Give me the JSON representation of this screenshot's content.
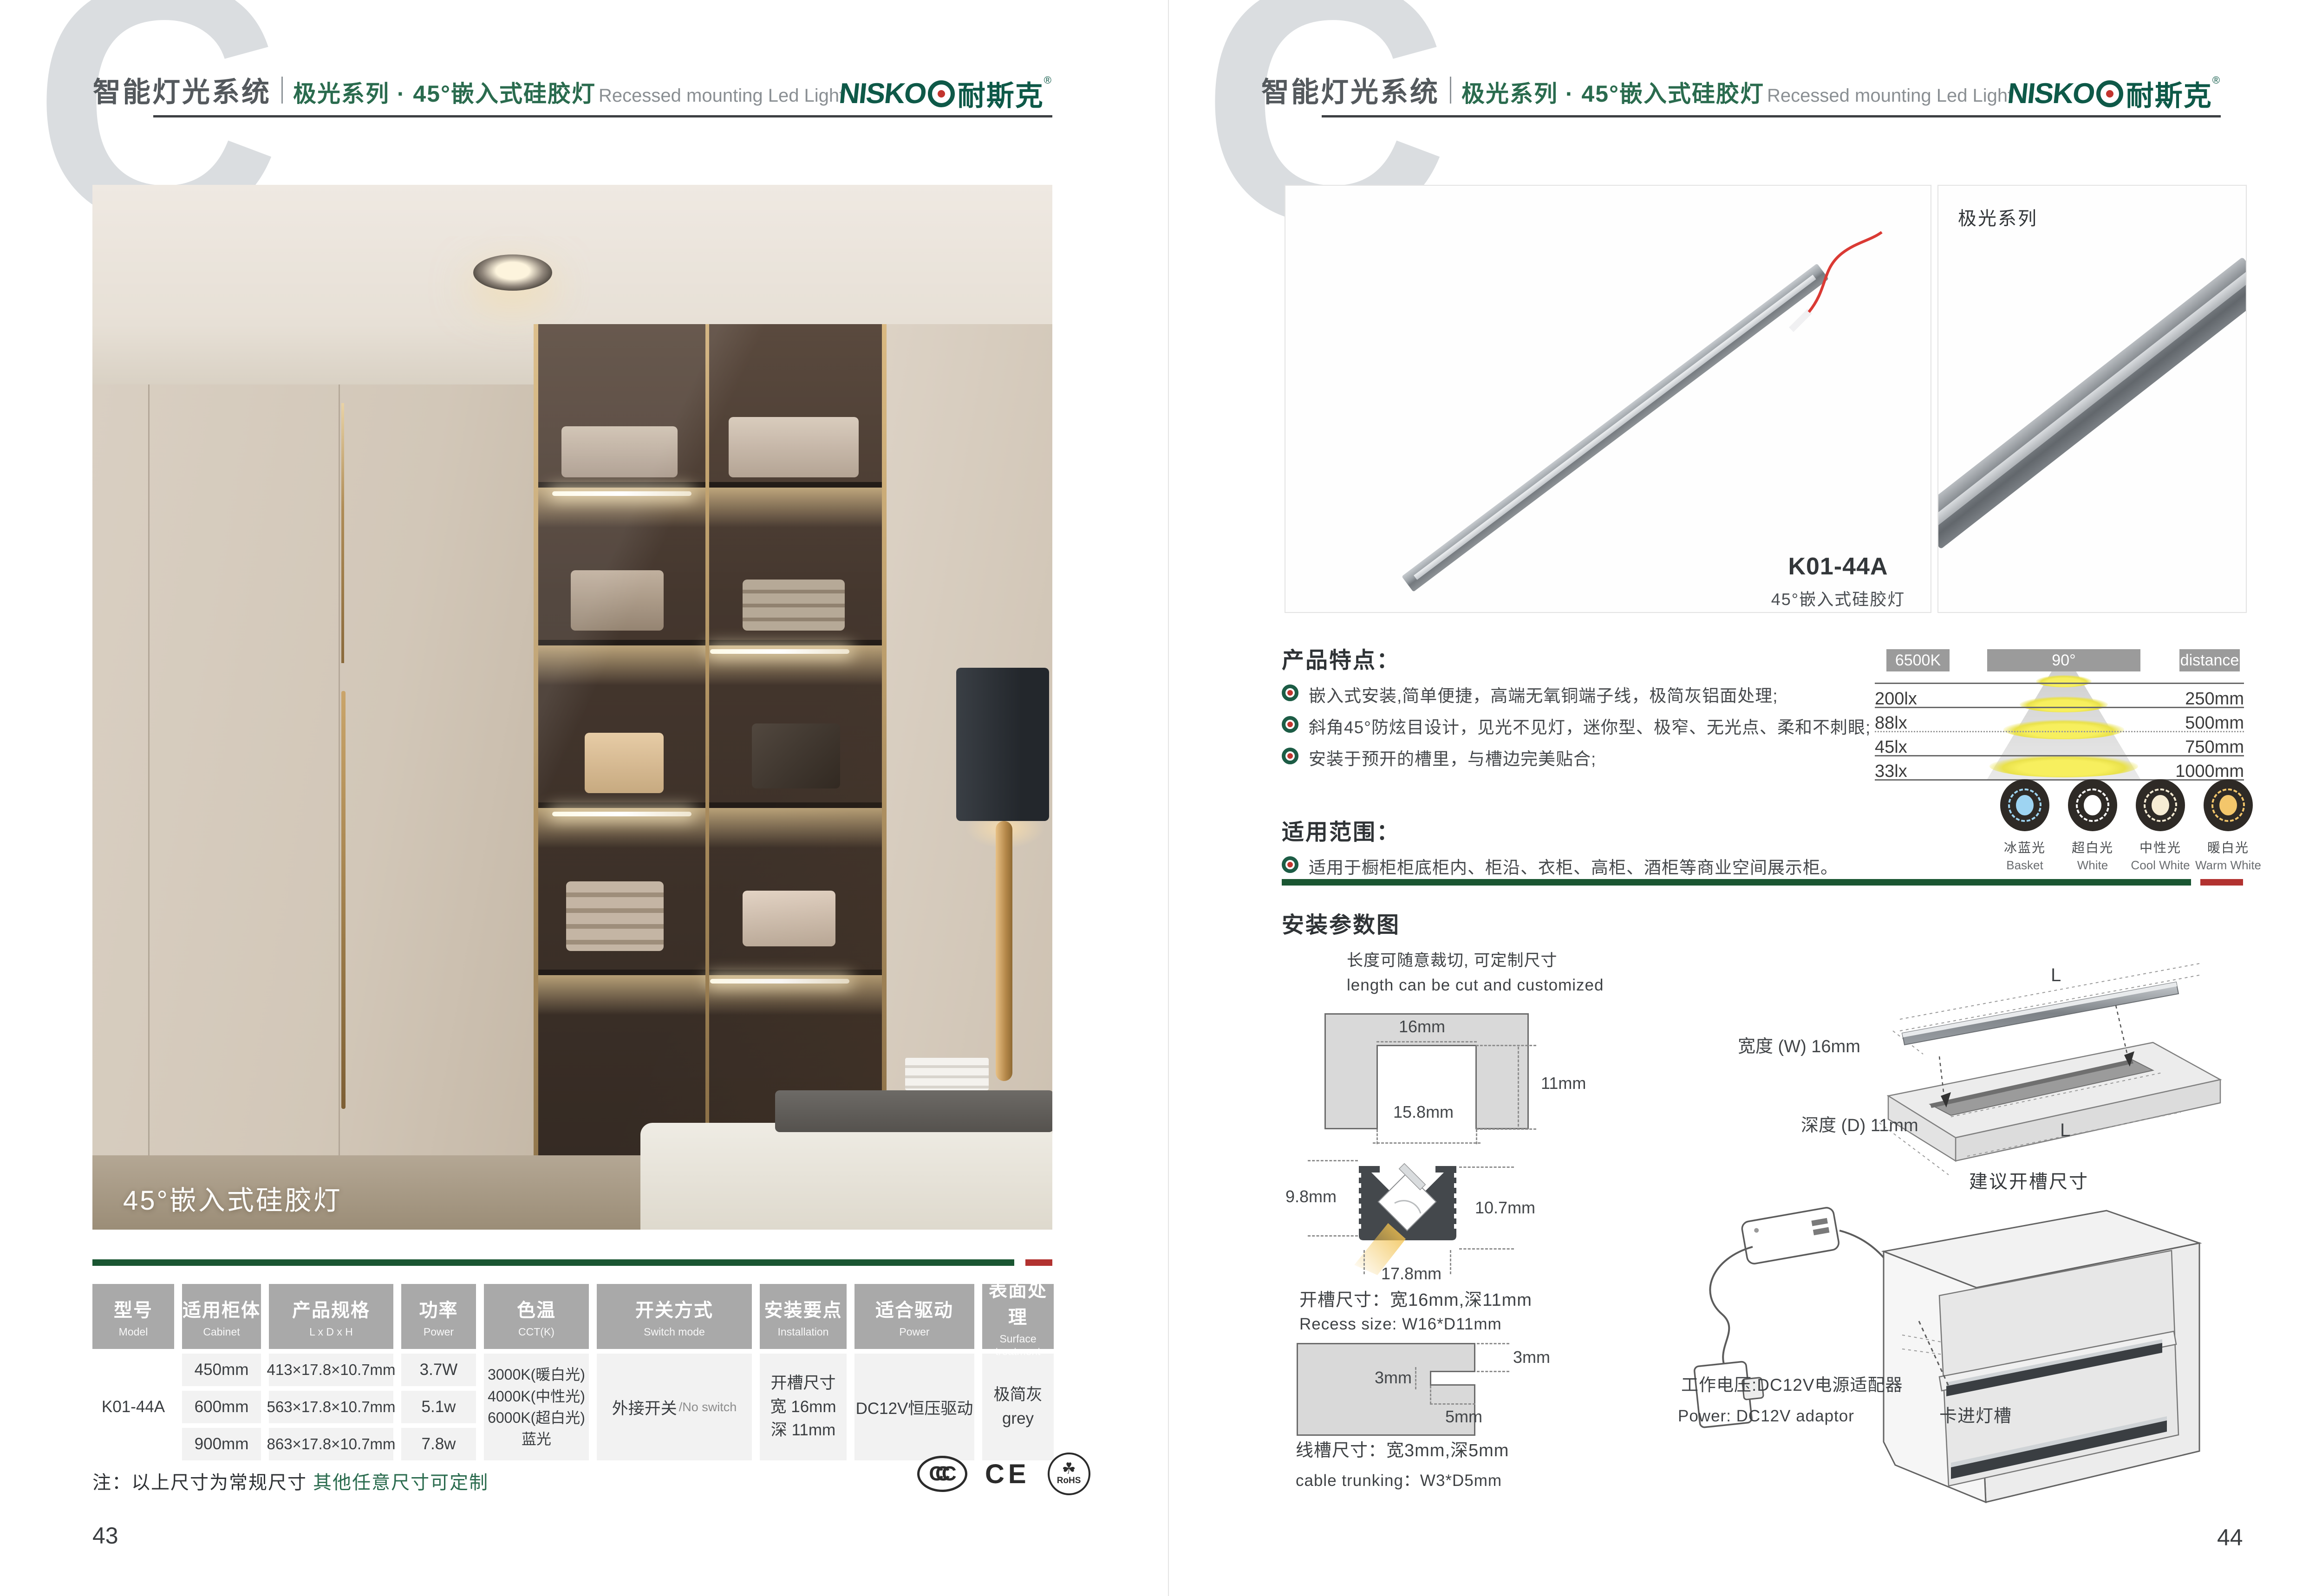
{
  "colors": {
    "brand_green": "#2a6b4e",
    "logo_green": "#0e5948",
    "divider_green": "#1a5632",
    "accent_red": "#b23230",
    "table_header_gray": "#a9a9a9"
  },
  "header": {
    "watermark": "C",
    "brand_title": "智能灯光系统",
    "series_title": "极光系列 · 45°嵌入式硅胶灯",
    "subtitle_en": "Recessed mounting Led Light",
    "logo": {
      "latin": "NISKO",
      "cn": "耐斯克",
      "reg": "®"
    }
  },
  "left_page": {
    "photo_caption": "45°嵌入式硅胶灯",
    "table": {
      "headers": [
        {
          "zh": "型号",
          "en": "Model"
        },
        {
          "zh": "适用柜体",
          "en": "Cabinet"
        },
        {
          "zh": "产品规格",
          "en": "L x D x H"
        },
        {
          "zh": "功率",
          "en": "Power"
        },
        {
          "zh": "色温",
          "en": "CCT(K)"
        },
        {
          "zh": "开关方式",
          "en": "Switch mode"
        },
        {
          "zh": "安装要点",
          "en": "Installation"
        },
        {
          "zh": "适合驱动",
          "en": "Power"
        },
        {
          "zh": "表面处理",
          "en": "Surface treatment"
        }
      ],
      "model": "K01-44A",
      "rows": [
        {
          "cabinet": "450mm",
          "spec": "413×17.8×10.7mm",
          "power": "3.7W"
        },
        {
          "cabinet": "600mm",
          "spec": "563×17.8×10.7mm",
          "power": "5.1w"
        },
        {
          "cabinet": "900mm",
          "spec": "863×17.8×10.7mm",
          "power": "7.8w"
        }
      ],
      "cct": [
        "3000K(暖白光)",
        "4000K(中性光)",
        "6000K(超白光)",
        "蓝光"
      ],
      "switch_zh": "外接开关",
      "switch_en": "/No switch",
      "install": [
        "开槽尺寸",
        "宽 16mm",
        "深 11mm"
      ],
      "driver": "DC12V恒压驱动",
      "surface": [
        "极简灰",
        "grey"
      ]
    },
    "note": {
      "prefix": "注：以上尺寸为常规尺寸 ",
      "highlight": "其他任意尺寸可定制"
    },
    "certs": [
      "CCC",
      "CE",
      "RoHS"
    ],
    "page_number": "43"
  },
  "right_page": {
    "panel1": {
      "model": "K01-44A",
      "name": "45°嵌入式硅胶灯"
    },
    "panel2": {
      "label": "极光系列"
    },
    "features": {
      "title": "产品特点：",
      "items": [
        "嵌入式安装,简单便捷，高端无氧铜端子线，极简灰铝面处理;",
        "斜角45°防炫目设计，见光不见灯，迷你型、极窄、无光点、柔和不刺眼;",
        "安装于预开的槽里，与槽边完美贴合;"
      ]
    },
    "scope": {
      "title": "适用范围：",
      "items": [
        "适用于橱柜柜底柜内、柜沿、衣柜、高柜、酒柜等商业空间展示柜。"
      ]
    },
    "chart": {
      "kelvin": "6500K",
      "angle": "90°",
      "distance_label": "distance",
      "rows": [
        {
          "lux": "200lx",
          "mm": "250mm"
        },
        {
          "lux": "88lx",
          "mm": "500mm"
        },
        {
          "lux": "45lx",
          "mm": "750mm"
        },
        {
          "lux": "33lx",
          "mm": "1000mm"
        }
      ]
    },
    "cct_legend": [
      {
        "zh": "冰蓝光",
        "en": "Basket",
        "color": "#9ed4f2"
      },
      {
        "zh": "超白光",
        "en": "White",
        "color": "#ffffff"
      },
      {
        "zh": "中性光",
        "en": "Cool White",
        "color": "#f6ecd4"
      },
      {
        "zh": "暖白光",
        "en": "Warm White",
        "color": "#f3c66b"
      }
    ],
    "install": {
      "title": "安装参数图",
      "cut_note_zh": "长度可随意裁切, 可定制尺寸",
      "cut_note_en": "length can be cut and customized",
      "recess": {
        "top": "16mm",
        "depth": "11mm",
        "inner": "15.8mm"
      },
      "profile": {
        "left": "9.8mm",
        "right": "10.7mm",
        "bottom": "17.8mm"
      },
      "recess_text_zh": "开槽尺寸：宽16mm,深11mm",
      "recess_text_en": "Recess size: W16*D11mm",
      "trunking": {
        "top": "3mm",
        "side": "3mm",
        "depth": "5mm"
      },
      "trunking_text_zh": "线槽尺寸：宽3mm,深5mm",
      "trunking_text_en": "cable trunking：W3*D5mm",
      "board": {
        "l_top": "L",
        "l_in": "L",
        "width_label": "宽度 (W) 16mm",
        "depth_label": "深度 (D) 11mm",
        "caption": "建议开槽尺寸"
      },
      "cabinet": {
        "power_zh": "工作电压:DC12V电源适配器",
        "power_en": "Power: DC12V adaptor",
        "clip_label": "卡进灯槽"
      }
    },
    "page_number": "44"
  }
}
